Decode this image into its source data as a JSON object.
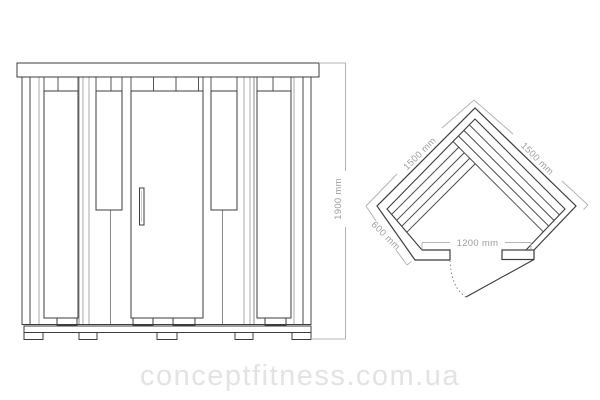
{
  "front": {
    "dim_height": "1900 mm"
  },
  "plan": {
    "dim_left_wall": "1500 mm",
    "dim_right_wall": "1500 mm",
    "dim_side_wall": "600 mm",
    "dim_front": "1200 mm"
  },
  "watermark": {
    "text": "conceptfitness.com.ua"
  },
  "colors": {
    "background": "#ffffff",
    "line_dark": "#3c3c3c",
    "line_medium": "#8a8a8a",
    "line_gray": "#a9a9a9",
    "dim_line": "#b4b4b4",
    "dim_text": "#9e9e9e",
    "watermark_text": "#e3e3e3"
  }
}
